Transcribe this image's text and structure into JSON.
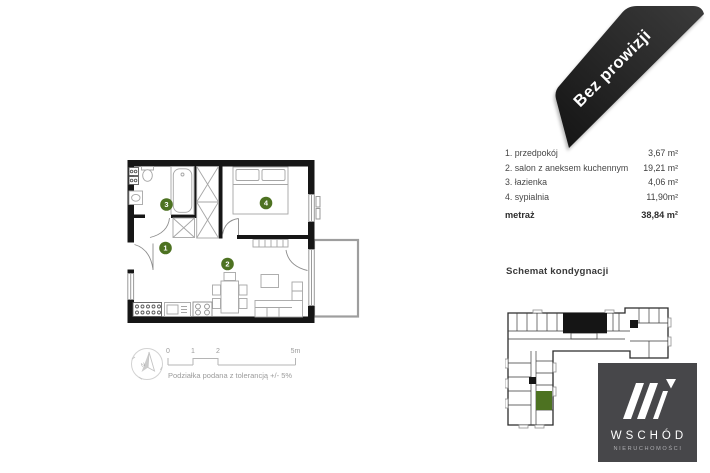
{
  "ribbon": {
    "label": "Bez prowizji",
    "color": "#262626"
  },
  "rooms": {
    "items": [
      {
        "label": "1. przedpokój",
        "area": "3,67 m²"
      },
      {
        "label": "2. salon z aneksem kuchennym",
        "area": "19,21 m²"
      },
      {
        "label": "3. łazienka",
        "area": "4,06 m²"
      },
      {
        "label": "4. sypialnia",
        "area": "11,90m²"
      }
    ],
    "total_label": "metraż",
    "total_area": "38,84 m²"
  },
  "plan": {
    "room_numbers": [
      "1",
      "2",
      "3",
      "4"
    ],
    "compass_label": "N",
    "scale_ticks": [
      "0",
      "1",
      "2",
      "5m"
    ],
    "scale_note": "Podziałka podana z tolerancją +/- 5%",
    "accent_green": "#4d7221"
  },
  "schematic": {
    "title": "Schemat kondygnacji",
    "highlight_color": "#4d7221"
  },
  "logo": {
    "name": "WSCHÓD",
    "subtitle": "NIERUCHOMOŚCI",
    "background": "#47474a"
  }
}
